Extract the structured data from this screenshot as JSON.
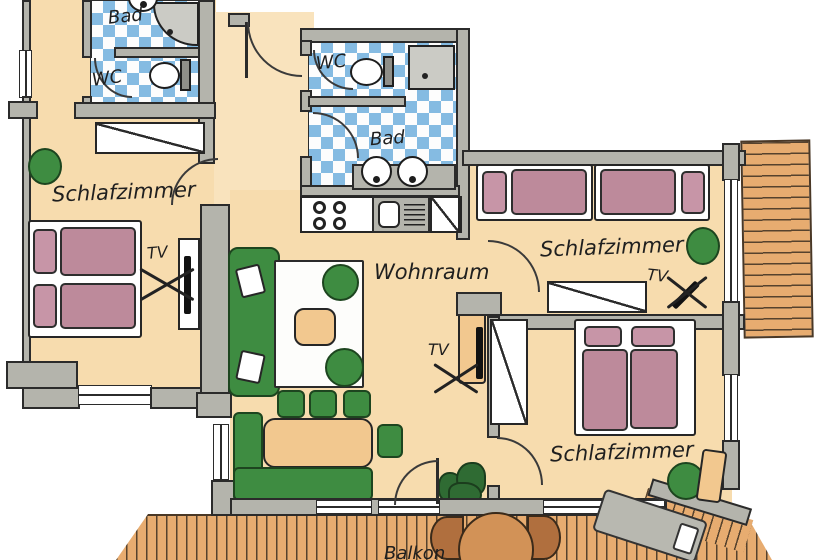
{
  "labels": {
    "bad1": "Bad",
    "wc1": "WC",
    "wc2": "WC",
    "bad2": "Bad",
    "schlafzimmer_left": "Schlafzimmer",
    "schlafzimmer_right_top": "Schlafzimmer",
    "schlafzimmer_right_bottom": "Schlafzimmer",
    "wohnraum": "Wohnraum",
    "balkon": "Balkon",
    "tv_left": "TV",
    "tv_living": "TV",
    "tv_right": "TV"
  },
  "colors": {
    "floor": "#f7dcae",
    "wall": "#b4b4ac",
    "tile_blue": "#85bbe2",
    "bed_pink": "#bd8a9b",
    "furniture_green": "#3e8c41",
    "wood": "#e7ac70",
    "outline": "#2b2b2b"
  }
}
